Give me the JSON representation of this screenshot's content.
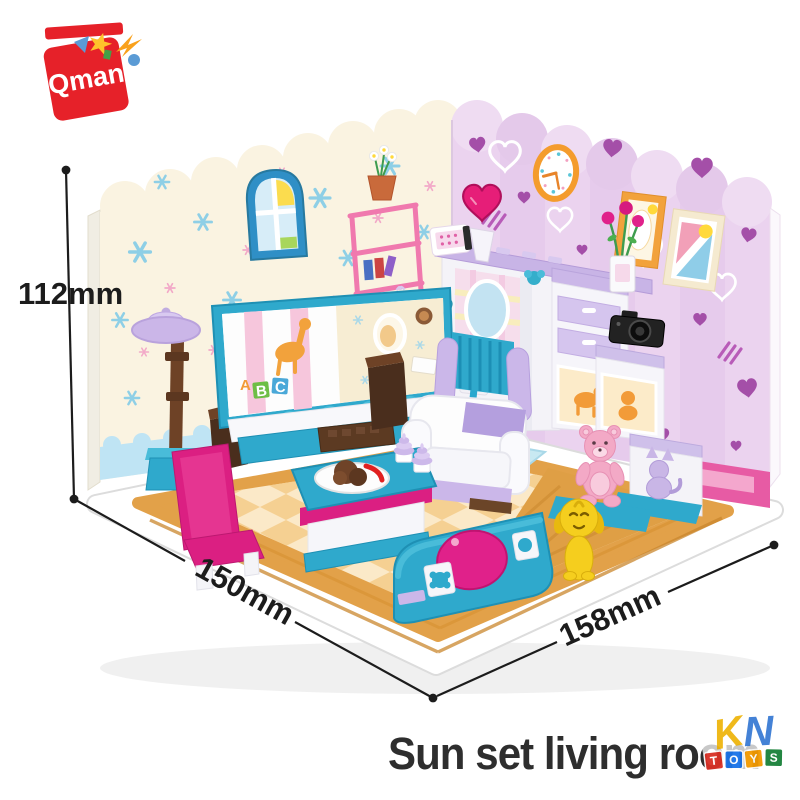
{
  "brand": {
    "name": "Qman",
    "logo_color": "#e62129"
  },
  "product": {
    "title": "Sun set living room"
  },
  "annotations": {
    "height": "112mm",
    "depth": "150mm",
    "width": "158mm"
  },
  "scene": {
    "tv_blocks": [
      "A",
      "B",
      "C"
    ],
    "elements": [
      "snowflake-wallpaper-wall",
      "heart-wallpaper-wall",
      "arched-window",
      "wall-clock",
      "picture-frames",
      "floor-lamp",
      "tv",
      "tv-stand",
      "speakers",
      "pink-bookshelf",
      "flower-pot",
      "heart-lamp",
      "radio",
      "vanity-mirror",
      "wall-shelf",
      "dresser",
      "flower-vase",
      "camera",
      "step-cabinet",
      "cat-figure",
      "hand-mirror",
      "armchair",
      "sofa",
      "teddy-bear",
      "pink-chair",
      "coffee-table",
      "food-plate",
      "ice-cream",
      "music-box",
      "puppy",
      "rug",
      "checkered-floor"
    ]
  },
  "watermark": {
    "letters": [
      "K",
      "N"
    ],
    "blocks": [
      "T",
      "O",
      "Y",
      "S"
    ]
  },
  "colors": {
    "brand_red": "#e62129",
    "teal": "#2fa9cc",
    "magenta": "#e0218a",
    "lavender": "#cbb7e9",
    "left_wall": "#faf3e1",
    "right_wall": "#ebd3ef",
    "floor_cream": "#fbe9c8",
    "wood": "#e2a149",
    "label_black": "#1c1c1c"
  }
}
